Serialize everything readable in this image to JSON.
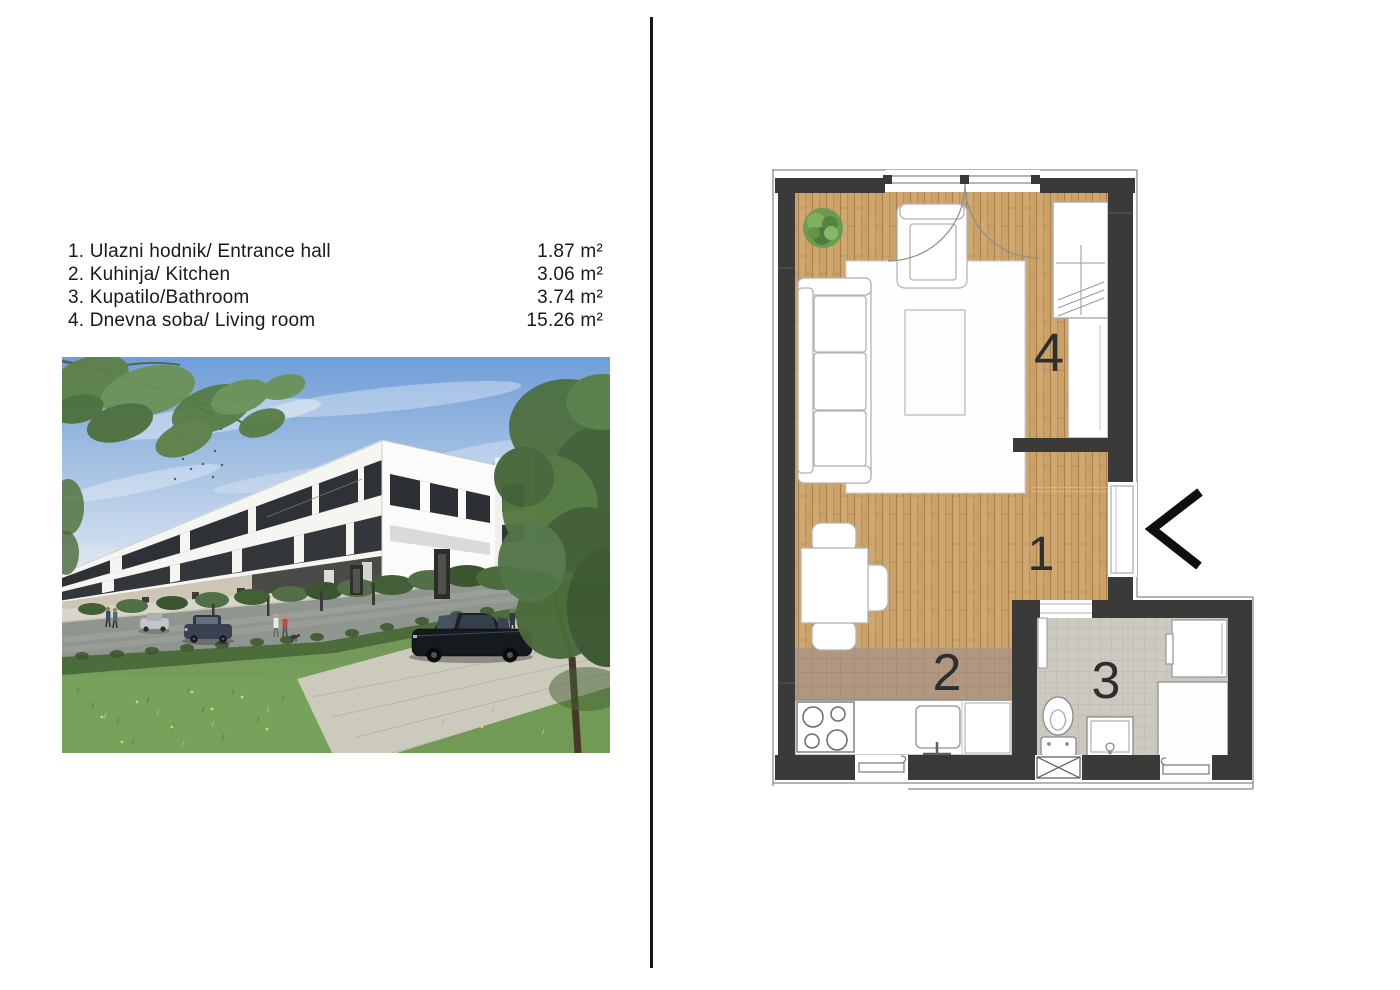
{
  "room_list": {
    "items": [
      {
        "label": "1. Ulazni hodnik/ Entrance hall",
        "area": "1.87 m²"
      },
      {
        "label": "2. Kuhinja/ Kitchen",
        "area": "3.06 m²"
      },
      {
        "label": "3. Kupatilo/Bathroom",
        "area": "3.74 m²"
      },
      {
        "label": "4. Dnevna soba/ Living room",
        "area": "15.26 m²"
      }
    ]
  },
  "floor_plan": {
    "room_labels": {
      "entrance_hall": "1",
      "kitchen": "2",
      "bathroom": "3",
      "living_room": "4"
    },
    "colors": {
      "wall": "#3a3a38",
      "wood_floor": "#c9a169",
      "kitchen_tile": "#b0977f",
      "bath_tile": "#cdc9c1"
    }
  },
  "photo": {
    "description": "3D exterior render of a modern white three-storey apartment building along a street, with lawn, trees, parked cars and pedestrians"
  }
}
